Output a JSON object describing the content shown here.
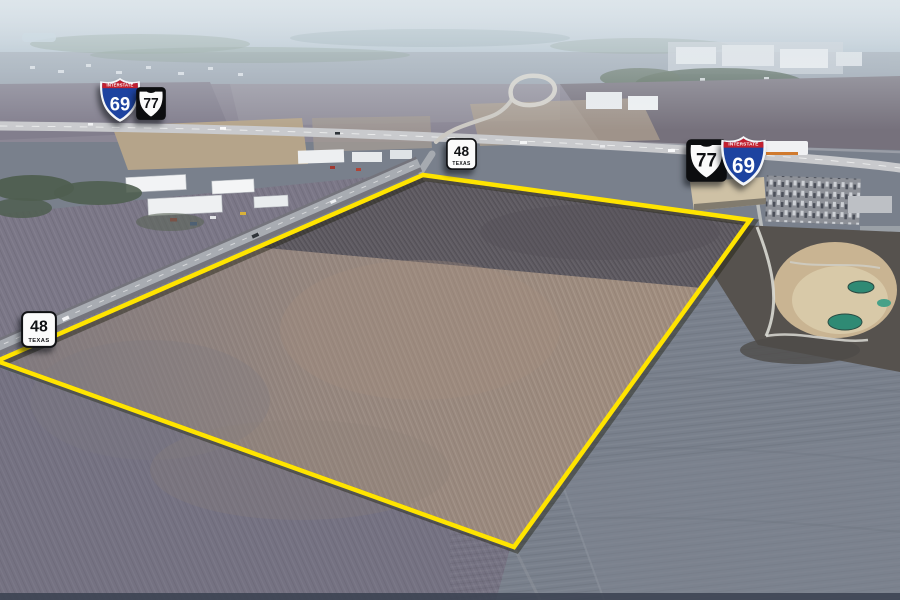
{
  "boundary": {
    "stroke_color": "#ffe400",
    "points": [
      [
        -3,
        361
      ],
      [
        423,
        175
      ],
      [
        750,
        220
      ],
      [
        514,
        547
      ]
    ]
  },
  "shields": {
    "interstate_banner_text": "INTERSTATE",
    "texas_state_label": "TEXAS",
    "items": [
      {
        "name": "interstate-69-upper-left",
        "kind": "interstate",
        "number": "69",
        "x": 99,
        "y": 77,
        "w": 42,
        "h": 46
      },
      {
        "name": "us-77-upper-left",
        "kind": "us-route",
        "number": "77",
        "x": 136,
        "y": 87,
        "w": 30,
        "h": 33
      },
      {
        "name": "texas-48-center",
        "kind": "texas-state",
        "number": "48",
        "x": 446,
        "y": 138,
        "w": 31,
        "h": 32
      },
      {
        "name": "us-77-right",
        "kind": "us-route",
        "number": "77",
        "x": 686,
        "y": 139,
        "w": 41,
        "h": 43
      },
      {
        "name": "interstate-69-right",
        "kind": "interstate",
        "number": "69",
        "x": 720,
        "y": 135,
        "w": 47,
        "h": 52
      },
      {
        "name": "texas-48-left",
        "kind": "texas-state",
        "number": "48",
        "x": 21,
        "y": 311,
        "w": 36,
        "h": 37
      }
    ]
  },
  "palette": {
    "boundary_yellow": "#ffe400",
    "interstate_blue": "#1d43a0",
    "interstate_red": "#c2202f",
    "shield_black": "#0c0d0f",
    "sign_white": "#fbfbfb",
    "field_dark_brown": "#5e5a61",
    "field_pink_brown": "#a08d7e",
    "field_gray": "#79808c",
    "haze_blue": "#a9bac7",
    "quarry_tan": "#c9b492",
    "pond_teal": "#2f8a74"
  }
}
